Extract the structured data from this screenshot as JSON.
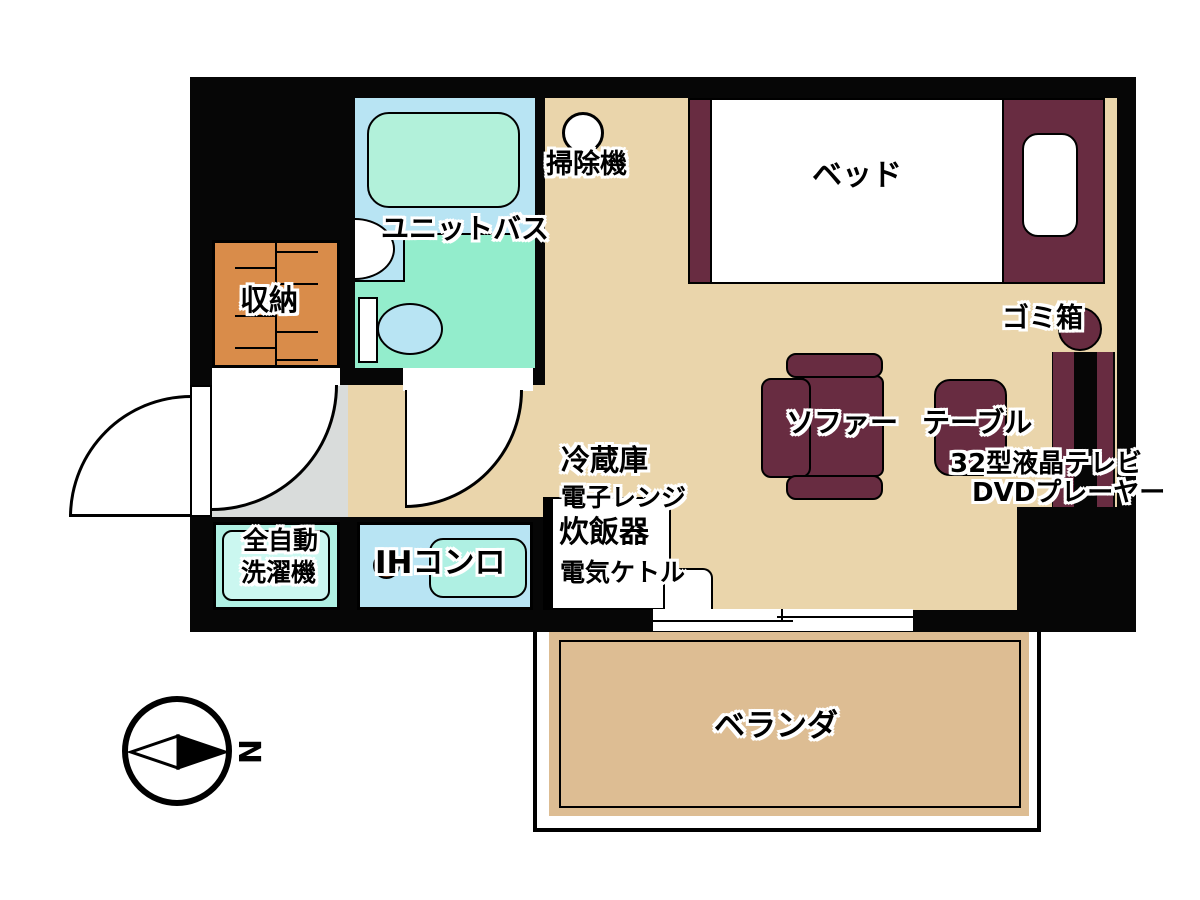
{
  "title": "ワンルーム間取り図",
  "rooms": {
    "unit_bath": "ユニットバス",
    "storage": "収納",
    "veranda": "ベランダ"
  },
  "furniture": {
    "vacuum": "掃除機",
    "bed": "ベッド",
    "trash": "ゴミ箱",
    "sofa": "ソファー",
    "table": "テーブル",
    "tv": "32型液晶テレビ",
    "dvd": "DVDプレーヤー",
    "fridge": "冷蔵庫",
    "microwave": "電子レンジ",
    "rice_cooker": "炊飯器",
    "kettle": "電気ケトル",
    "ih_stove": "IHコンロ",
    "washer_line1": "全自動",
    "washer_line2": "洗濯機"
  },
  "compass": {
    "north": "N"
  },
  "colors": {
    "wall": "#060606",
    "floor_tan": "#ead5ab",
    "veranda_tan": "#ddbd93",
    "entry_gray": "#d9dcdb",
    "furniture_maroon": "#682c41",
    "storage_orange": "#d98c4a",
    "bath_blue": "#b8e4f3",
    "bath_green": "#93edcc",
    "bathtub_mint": "#b2f1da",
    "appliance_cyan": "#aff0e3",
    "knob_brown": "#6e3a1d"
  }
}
